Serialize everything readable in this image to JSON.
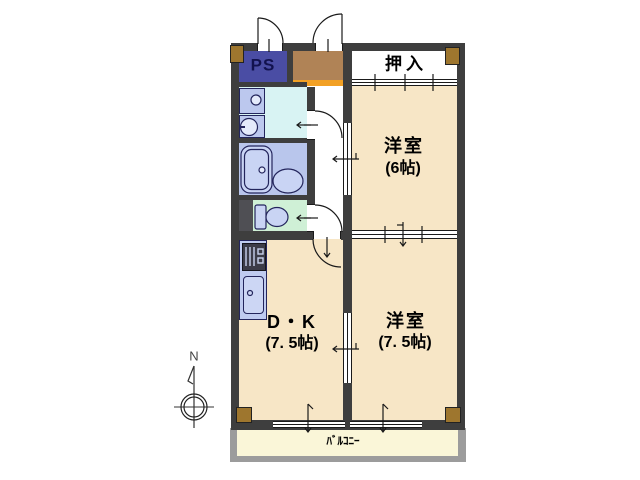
{
  "title": "apartment-floorplan",
  "plan": {
    "rooms": {
      "ps": {
        "label": "PS"
      },
      "closet": {
        "label": "押入"
      },
      "room6": {
        "name": "洋室",
        "size": "(6帖)"
      },
      "room75": {
        "name": "洋室",
        "size": "(7. 5帖)"
      },
      "dk": {
        "name": "D・K",
        "size": "(7. 5帖)"
      },
      "balcony": {
        "label": "ﾊﾞﾙｺﾆｰ"
      }
    },
    "compass": {
      "north": "N"
    },
    "colors": {
      "wall": "#3E3E3E",
      "room_floor": "#F7E6C6",
      "closet_floor": "#FFFFFF",
      "hall_floor": "#FFFFFF",
      "ps_box": "#4A4DA4",
      "entry_floor": "#B08356",
      "entry_step": "#F2A024",
      "washroom_floor": "#D8F3F3",
      "bathroom_floor": "#B9C6EC",
      "toilet_floor": "#CFF0D6",
      "fixture_fill": "#C9D4F4",
      "fixture_light": "#E4EAFB",
      "fixture_outline": "#23255C",
      "kitchen_counter": "#BFCBF0",
      "sink_fill": "#CCD6F4",
      "stove": "#3C3C48",
      "shaft": "#4F4F54",
      "balcony_floor": "#FAF6D8",
      "balcony_rail": "#9C9C9C",
      "corner_block": "#9E762E"
    }
  }
}
